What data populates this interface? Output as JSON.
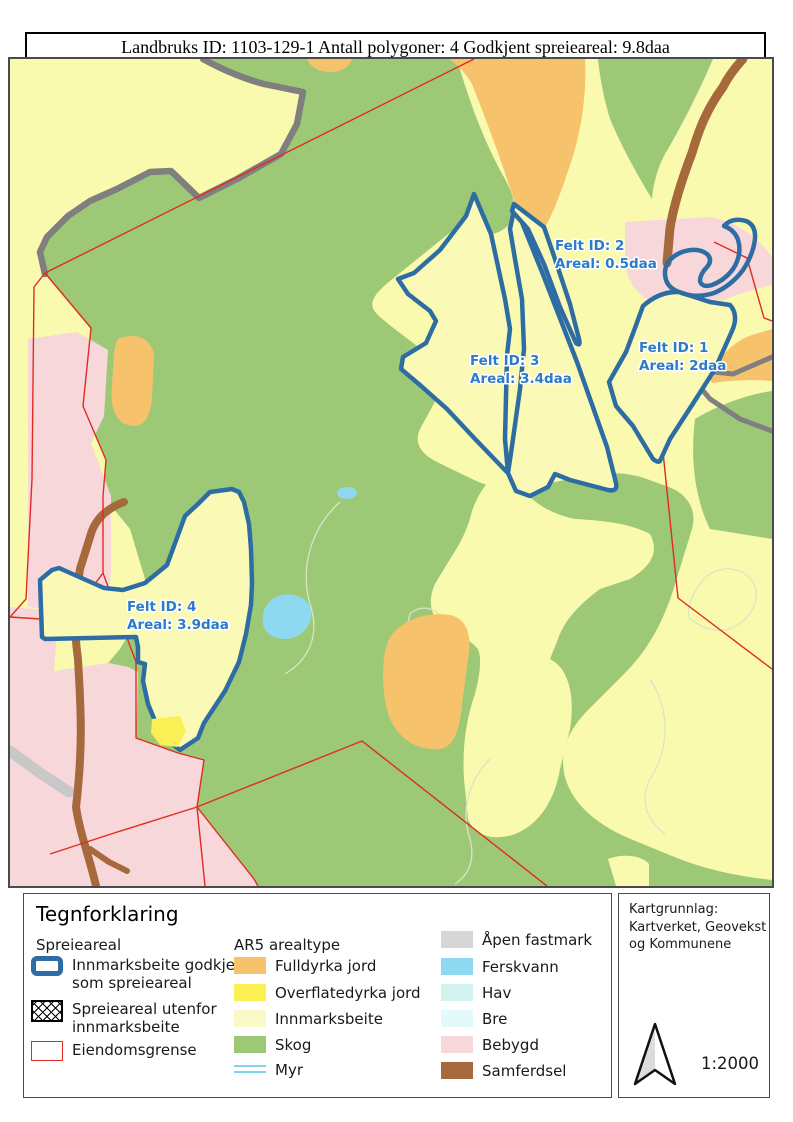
{
  "title_bar": {
    "text": "Landbruks ID: 1103-129-1 Antall polygoner: 4 Godkjent spreieareal: 9.8daa"
  },
  "map_fields": [
    {
      "id_label": "Felt ID: 1",
      "areal_label": "Areal: 2daa"
    },
    {
      "id_label": "Felt ID: 2",
      "areal_label": "Areal: 0.5daa"
    },
    {
      "id_label": "Felt ID: 3",
      "areal_label": "Areal: 3.4daa"
    },
    {
      "id_label": "Felt ID: 4",
      "areal_label": "Areal: 3.9daa"
    }
  ],
  "legend": {
    "title": "Tegnforklaring",
    "spreieareal": {
      "header": "Spreieareal",
      "items": [
        {
          "symbol": "blue-outline",
          "label_line1": "Innmarksbeite godkjent",
          "label_line2": "som spreieareal"
        },
        {
          "symbol": "crosshatch",
          "label_line1": "Spreieareal utenfor",
          "label_line2": "innmarksbeite"
        },
        {
          "symbol": "red-outline",
          "label_line1": "Eiendomsgrense",
          "label_line2": ""
        }
      ]
    },
    "ar5": {
      "header": "AR5 arealtype",
      "items": [
        {
          "label": "Fulldyrka jord",
          "color": "#F6C26B"
        },
        {
          "label": "Overflatedyrka jord",
          "color": "#FAF053"
        },
        {
          "label": "Innmarksbeite",
          "color": "#FAFAC8"
        },
        {
          "label": "Skog",
          "color": "#9DC977"
        },
        {
          "label": "Myr",
          "color": ""
        },
        {
          "label": "Åpen fastmark",
          "color": "#D6D6D6"
        },
        {
          "label": "Ferskvann",
          "color": "#8FD9F0"
        },
        {
          "label": "Hav",
          "color": "#D2F3F0"
        },
        {
          "label": "Bre",
          "color": "#E4F9F9"
        },
        {
          "label": "Bebygd",
          "color": "#F8D7DA"
        },
        {
          "label": "Samferdsel",
          "color": "#A5693C"
        }
      ]
    }
  },
  "info_box": {
    "kartgrunnlag_line1": "Kartgrunnlag:",
    "kartgrunnlag_line2": "Kartverket, Geovekst",
    "kartgrunnlag_line3": "og Kommunene",
    "scale": "1:2000"
  },
  "colors": {
    "innmarksbeite_map": "#FAFAAF",
    "skog": "#9DC977",
    "fulldyrka_jord": "#F6C26B",
    "overflatedyrka_jord": "#FAF053",
    "ferskvann": "#8FD9F0",
    "bebygd": "#F8D7DA",
    "samferdsel": "#A5693C",
    "road_gray": "#7F7F7F",
    "road_gray_light": "#C8C8C8",
    "eiendomsgrense": "#E02B20",
    "felt_outline": "#2E6DA4",
    "felt_label_text": "#2B7BC8",
    "contour": "#D8E6C4"
  }
}
